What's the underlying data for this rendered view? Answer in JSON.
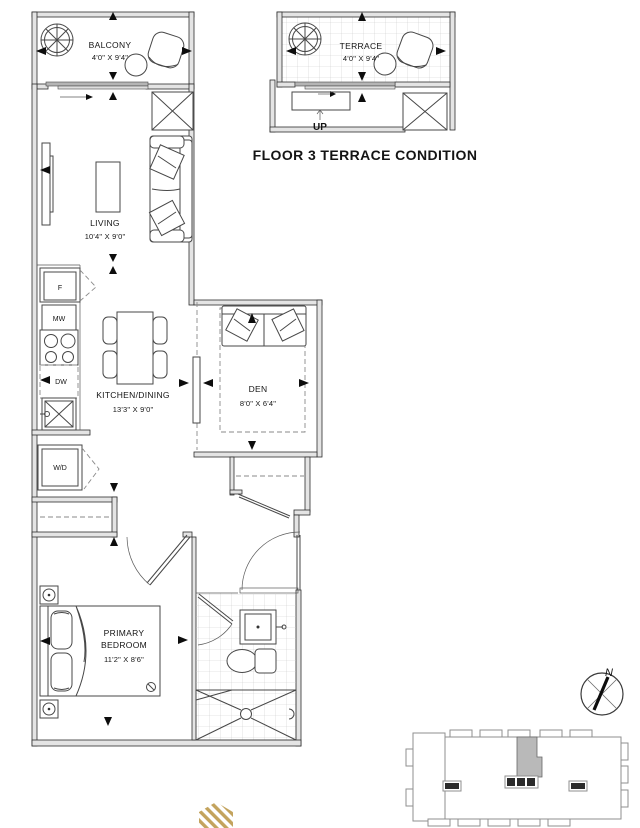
{
  "floor_plan": {
    "unit": {
      "balcony": {
        "label": "BALCONY",
        "dimensions": "4'0\" X 9'4\""
      },
      "living": {
        "label": "LIVING",
        "dimensions": "10'4\" X 9'0\""
      },
      "kitchen_dining": {
        "label": "KITCHEN/DINING",
        "dimensions": "13'3\" X 9'0\""
      },
      "den": {
        "label": "DEN",
        "dimensions": "8'0\" X 6'4\""
      },
      "primary_bedroom": {
        "label_line1": "PRIMARY",
        "label_line2": "BEDROOM",
        "dimensions": "11'2\" X 8'6\""
      },
      "appliances": {
        "fridge": "F",
        "microwave": "MW",
        "dishwasher": "DW",
        "washer_dryer": "W/D"
      }
    },
    "terrace_detail": {
      "title": "FLOOR 3 TERRACE CONDITION",
      "terrace": {
        "label": "TERRACE",
        "dimensions": "4'0\" X 9'4\""
      },
      "stair_label": "UP"
    },
    "compass": {
      "label": "N"
    },
    "colors": {
      "linework": "#474747",
      "wall_fill": "#e4e4e4",
      "tile_line": "#cccccc",
      "unit_highlight": "#b9b9b9",
      "logo_gold": "#c3a35d"
    }
  }
}
